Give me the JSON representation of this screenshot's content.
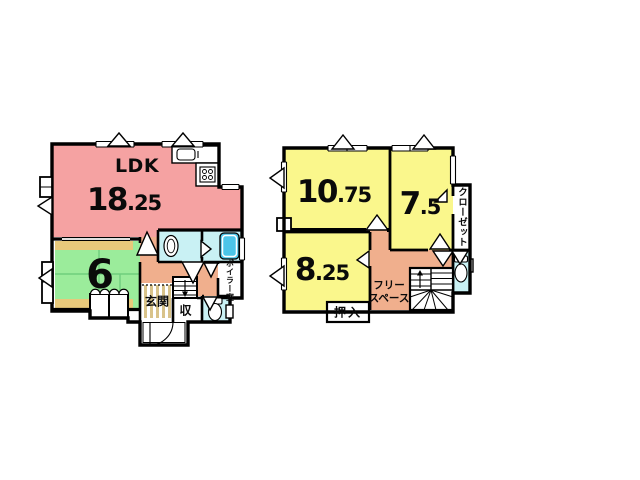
{
  "floorplan": {
    "floor1": {
      "ldk_label": "LDK",
      "ldk_num": "18",
      "ldk_dec": ".25",
      "tatami_num": "6",
      "genkan": "玄関",
      "storage": "収",
      "boiler": "ボイラー室"
    },
    "floor2": {
      "room1_num": "10",
      "room1_dec": ".75",
      "room2_num": "7",
      "room2_dec": ".5",
      "room3_num": "8",
      "room3_dec": ".25",
      "closet": "クローゼット",
      "oshiire": "押入",
      "free_line1": "フリー",
      "free_line2": "スペース"
    },
    "colors": {
      "pink": "#F5A2A2",
      "yellow": "#FAF78C",
      "green": "#9BEC9B",
      "tan": "#E8C97B",
      "orange": "#F0AF8D",
      "cyan": "#C9F1F4",
      "tub": "#4CC5E8",
      "genkanStripe": "#D9C38A",
      "wall": "#000000"
    }
  }
}
